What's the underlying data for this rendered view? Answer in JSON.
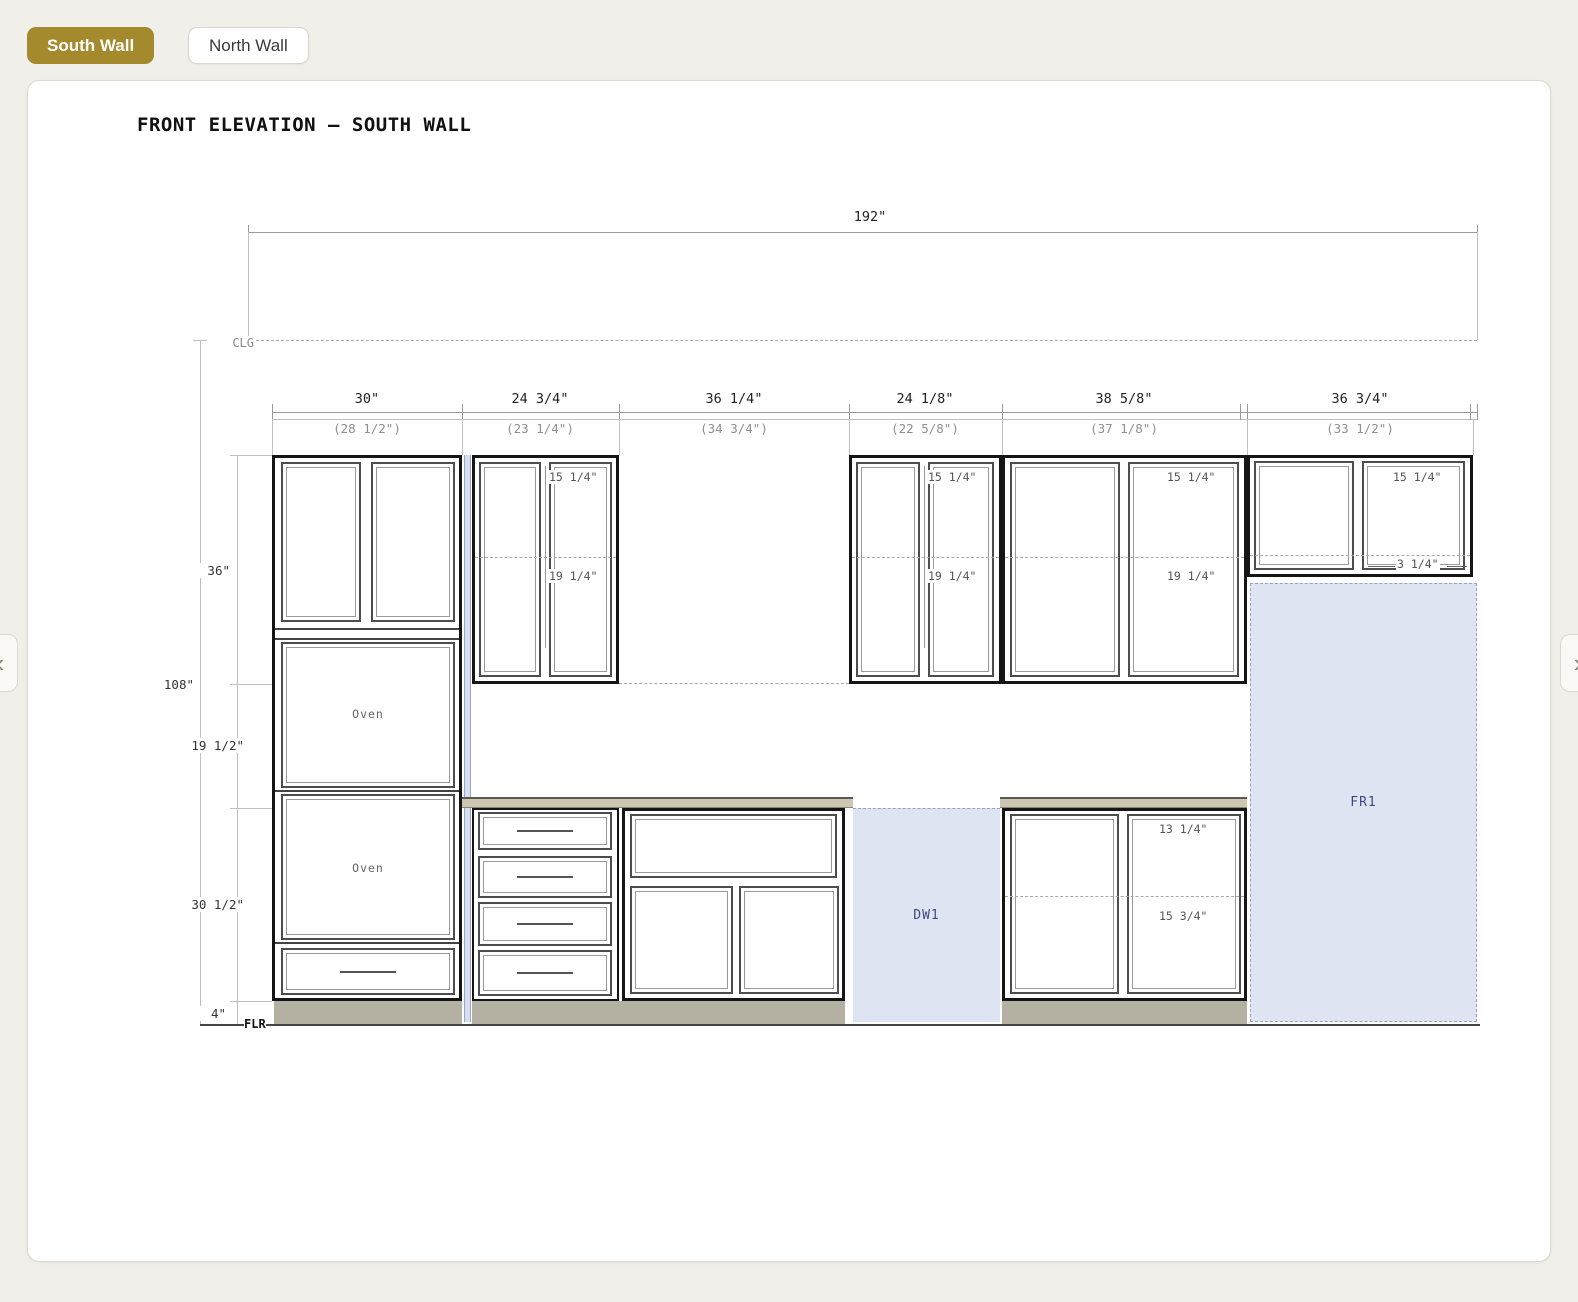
{
  "tabs": {
    "south": "South Wall",
    "north": "North Wall"
  },
  "nav": {
    "prev": "‹",
    "next": "›"
  },
  "drawing": {
    "title": "FRONT ELEVATION — SOUTH WALL",
    "overall_width": "192\"",
    "levels": {
      "ceiling": "CLG",
      "floor": "FLR"
    },
    "sections": [
      {
        "width": "30\"",
        "opening": "(28 1/2\")"
      },
      {
        "width": "24 3/4\"",
        "opening": "(23 1/4\")"
      },
      {
        "width": "36 1/4\"",
        "opening": "(34 3/4\")"
      },
      {
        "width": "24 1/8\"",
        "opening": "(22 5/8\")"
      },
      {
        "width": "38 5/8\"",
        "opening": "(37 1/8\")"
      },
      {
        "width": "36 3/4\"",
        "opening": "(33 1/2\")"
      }
    ],
    "heights": {
      "upper_cabinet": "36\"",
      "total": "108\"",
      "backsplash_gap": "19 1/2\"",
      "base_cabinet": "30 1/2\"",
      "toe_kick": "4\""
    },
    "interior_dims": {
      "wall2": {
        "top": "15 1/4\"",
        "bottom": "19 1/4\""
      },
      "wall4": {
        "top": "15 1/4\"",
        "bottom": "19 1/4\""
      },
      "wall5": {
        "top": "15 1/4\"",
        "bottom": "19 1/4\""
      },
      "wall6": {
        "top": "15 1/4\"",
        "bottom": "3 1/4\""
      },
      "base5": {
        "top": "13 1/4\"",
        "bottom": "15 3/4\""
      }
    },
    "appliances": {
      "oven1": "Oven",
      "oven2": "Oven",
      "dishwasher": "DW1",
      "fridge": "FR1"
    }
  },
  "colors": {
    "accent_gold": "#A58A2D",
    "page_bg": "#F1EFE9",
    "appliance_fill": "#DEE4F2",
    "appliance_text": "#3C4C7E",
    "countertop": "#CCC6B3",
    "toe_kick": "#B4B0A2"
  }
}
